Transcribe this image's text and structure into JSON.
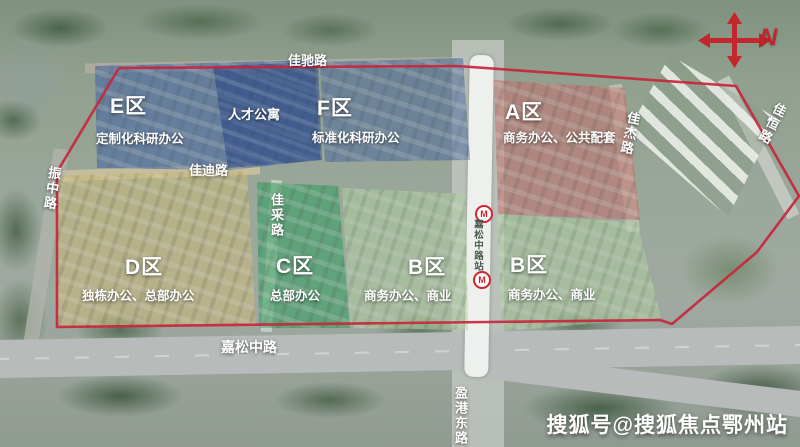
{
  "compass": {
    "label": "N"
  },
  "watermark": {
    "text": "搜狐号@搜狐焦点鄂州站"
  },
  "boundary_color": "#c5273a",
  "zones": [
    {
      "code": "E区",
      "desc": "定制化科研办公",
      "color": "#3b5fa8"
    },
    {
      "code": "F区",
      "desc": "标准化科研办公",
      "color": "#49689f"
    },
    {
      "code": "A区",
      "desc": "商务办公、公共配套",
      "color": "#c4706c"
    },
    {
      "code": "D区",
      "desc": "独栋办公、总部办公",
      "color": "#c9b97a"
    },
    {
      "code": "C区",
      "desc": "总部办公",
      "color": "#2f9e5e"
    },
    {
      "code": "B区",
      "desc": "商务办公、商业",
      "color": "#aecf9d"
    },
    {
      "code": "B区",
      "desc": "商务办公、商业",
      "color": "#aecf9d"
    }
  ],
  "buildings": {
    "talent_apartment": "人才公寓"
  },
  "roads": {
    "jiachi": "佳驰路",
    "jiadi": "佳迪路",
    "jiacai": "佳采路",
    "jiajie": "佳杰路",
    "jiaheng": "佳恒路",
    "zhenzhong": "振中路",
    "jiasong": "嘉松中路",
    "yinggang": "盈港东路"
  },
  "metro": {
    "station": "嘉松中路站",
    "logo_letter": "M"
  }
}
